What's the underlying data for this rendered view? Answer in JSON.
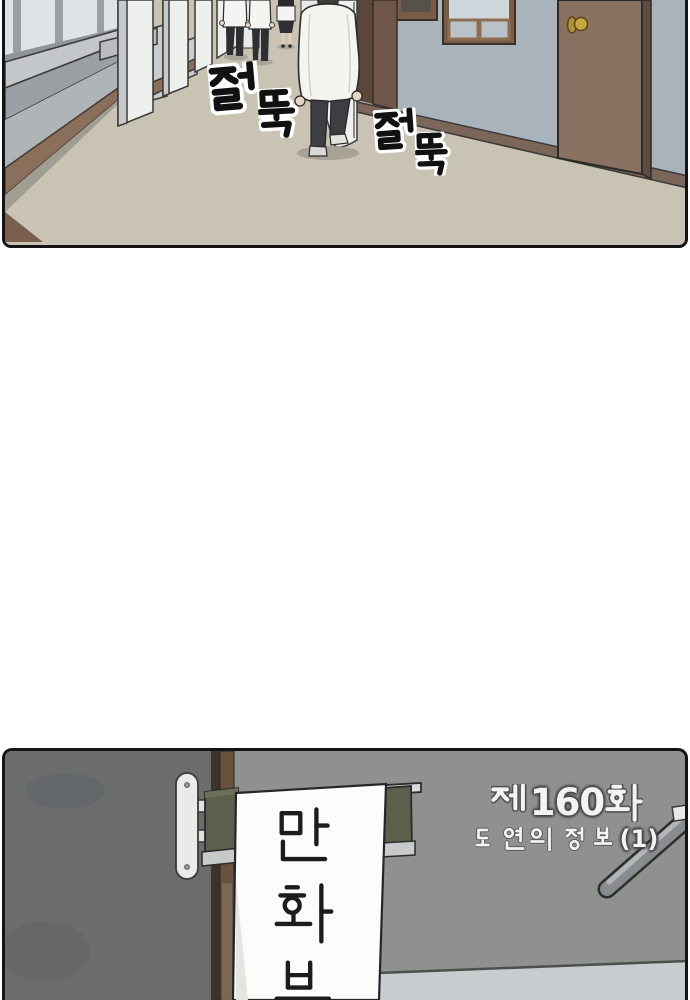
{
  "page": {
    "type": "webtoon-page",
    "background": "#ffffff"
  },
  "panel_hallway": {
    "description_names": [
      "school-hallway",
      "students-walking"
    ],
    "sound_effects": [
      {
        "text": "절뚝"
      },
      {
        "text": "절뚝"
      }
    ],
    "colors": {
      "floor": "#c9c3b4",
      "right_wall": "#a9b3bb",
      "left_wall": "#afb4b7",
      "pillar": "#eef0ee",
      "baseboard": "#8a6f5a",
      "door_brown": "#8a7263",
      "doorknob_gold": "#c9a83c",
      "uniform_shirt": "#f5f4f1",
      "uniform_pants": "#3d3e42",
      "outline": "#141414"
    }
  },
  "panel_club": {
    "banner": {
      "text": "만화부",
      "chars": [
        "만",
        "화",
        "부"
      ]
    },
    "episode": {
      "label": "제160화",
      "prefix": "제",
      "number": "160",
      "suffix": "화",
      "subtitle": "도연의 정보 (1)",
      "subtitle_words": [
        "도연의",
        "정보"
      ],
      "subtitle_tail": "(1)"
    },
    "colors": {
      "wall_gray": "#8e918d",
      "wall_dark": "#6b6e6c",
      "door_frame": "#66523f",
      "sign_green": "#5d5e4c",
      "bracket_silver": "#e9ebea",
      "banner_white": "#fcfcfb",
      "lower_wall": "#c7ccce",
      "railing_gray": "#888c8f",
      "title_text": "#f3f4f2",
      "banner_text": "#1c1c1c"
    }
  }
}
